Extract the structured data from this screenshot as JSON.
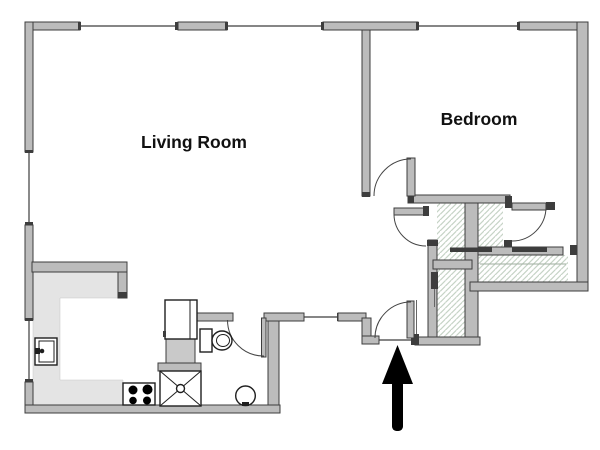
{
  "labels": {
    "living_room": "Living Room",
    "bedroom": "Bedroom"
  },
  "colors": {
    "background": "#ffffff",
    "wall_fill": "#bcbcbc",
    "wall_stroke": "#3d3d3d",
    "counter_fill": "#e4e4e4",
    "cabinet_fill": "#c9c9c9",
    "hatch_line": "#c6d3c6",
    "fixture_stroke": "#1f1f1f",
    "door_arc": "#444444",
    "arrow": "#000000"
  },
  "fixtures": {
    "kitchen": [
      "counter",
      "kitchen-sink",
      "stove",
      "washer",
      "refrigerator",
      "cabinet"
    ],
    "bathroom": [
      "toilet",
      "round-basin"
    ],
    "closets": [
      "closet-rod",
      "closet-shelf"
    ],
    "entrance": [
      "entry-arrow"
    ]
  }
}
